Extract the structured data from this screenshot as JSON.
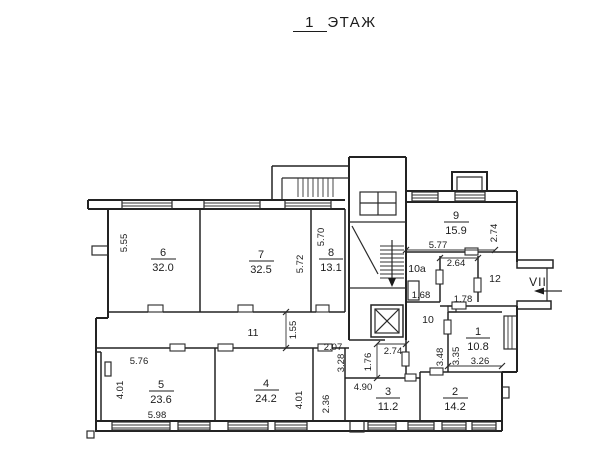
{
  "title": {
    "floor_number": "1",
    "floor_word": "ЭТАЖ"
  },
  "plan": {
    "rooms": {
      "r1": {
        "number": "1",
        "area": "10.8"
      },
      "r2": {
        "number": "2",
        "area": "14.2"
      },
      "r3": {
        "number": "3",
        "area": "11.2"
      },
      "r4": {
        "number": "4",
        "area": "24.2"
      },
      "r5": {
        "number": "5",
        "area": "23.6"
      },
      "r6": {
        "number": "6",
        "area": "32.0"
      },
      "r7": {
        "number": "7",
        "area": "32.5"
      },
      "r8": {
        "number": "8",
        "area": "13.1"
      },
      "r9": {
        "number": "9",
        "area": "15.9"
      }
    },
    "spaces": {
      "s10": {
        "label": "10"
      },
      "s10a": {
        "label": "10а"
      },
      "s11": {
        "label": "11"
      },
      "s12": {
        "label": "12"
      }
    },
    "entrance": {
      "label": "VII"
    },
    "dimensions": {
      "room6_height": "5.55",
      "room7_height": "5.72",
      "room8_height": "5.70",
      "room9_width": "5.77",
      "room9_height": "2.74",
      "room10a_width": "2.64",
      "room10a_inner": "1.68",
      "hall_width": "1.78",
      "corridor11_width": "1.55",
      "nook_width": "2.07",
      "nook_height": "3.28",
      "stair_width": "2.74",
      "vestibule_height": "1.76",
      "hall10_height": "3.48",
      "room1_height": "3.35",
      "room1_width": "3.26",
      "room3_width": "4.90",
      "strip_height": "2.36",
      "room4_height": "4.01",
      "room5_height": "4.01",
      "room5_width_top": "5.76",
      "room5_width_bottom": "5.98"
    }
  }
}
